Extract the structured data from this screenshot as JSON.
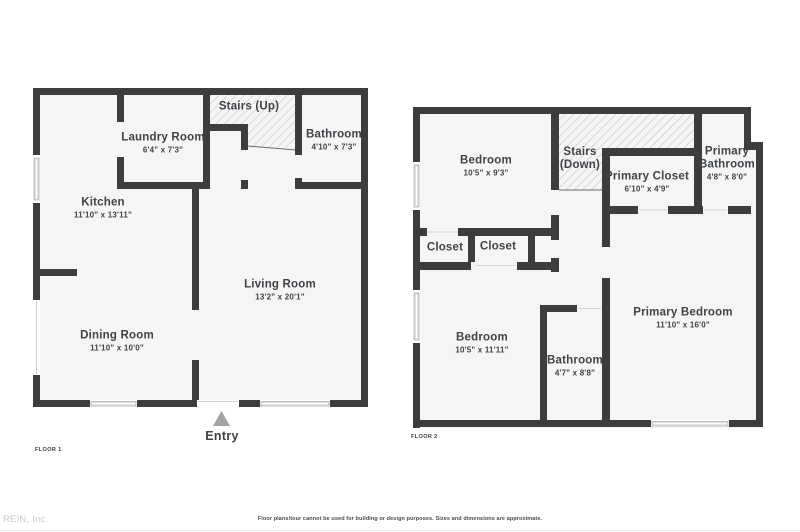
{
  "watermark": "REIN, Inc.",
  "disclaimer": "Floor plans/tour cannot be used for building or design purposes. Sizes and dimensions are approximate.",
  "colors": {
    "wall": "#3d3d3d",
    "floor_fill": "#f5f5f5",
    "hatch_line": "#c4c4c4",
    "label_text": "#3f4347",
    "entry_arrow": "#a3a3a3",
    "watermark_text": "#c6cbd0"
  },
  "floor1": {
    "label": "FLOOR 1",
    "entry_label": "Entry",
    "rooms": [
      {
        "name": "Laundry Room",
        "dims": "6'4\" x 7'3\""
      },
      {
        "name": "Stairs (Up)",
        "dims": ""
      },
      {
        "name": "Bathroom",
        "dims": "4'10\" x 7'3\""
      },
      {
        "name": "Kitchen",
        "dims": "11'10\" x 13'11\""
      },
      {
        "name": "Living Room",
        "dims": "13'2\" x 20'1\""
      },
      {
        "name": "Dining Room",
        "dims": "11'10\" x 10'0\""
      }
    ]
  },
  "floor2": {
    "label": "FLOOR 2",
    "rooms": [
      {
        "name": "Bedroom",
        "dims": "10'5\" x 9'3\""
      },
      {
        "name": "Stairs (Down)",
        "dims": ""
      },
      {
        "name": "Primary Closet",
        "dims": "6'10\" x 4'9\""
      },
      {
        "name": "Primary Bathroom",
        "dims": "4'8\" x 8'0\""
      },
      {
        "name": "Closet",
        "dims": ""
      },
      {
        "name": "Closet",
        "dims": ""
      },
      {
        "name": "Bedroom",
        "dims": "10'5\" x 11'11\""
      },
      {
        "name": "Bathroom",
        "dims": "4'7\" x 8'8\""
      },
      {
        "name": "Primary Bedroom",
        "dims": "11'10\" x 16'0\""
      }
    ]
  }
}
